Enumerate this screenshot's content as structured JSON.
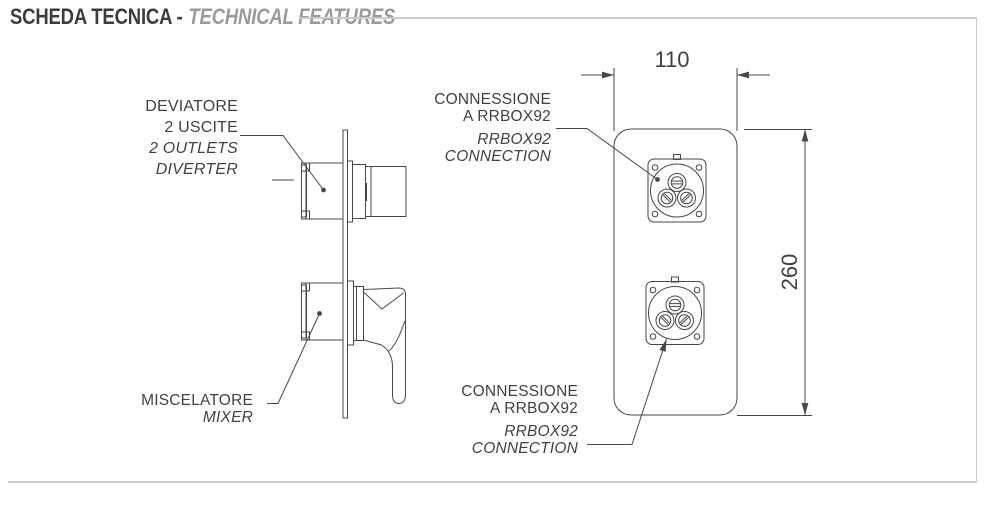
{
  "header": {
    "title_primary": "SCHEDA TECNICA -",
    "title_secondary": "TECHNICAL FEATURES"
  },
  "labels": {
    "diverter": {
      "line1": "DEVIATORE",
      "line2": "2 USCITE",
      "line3": "2 OUTLETS",
      "line4": "DIVERTER"
    },
    "mixer": {
      "line1": "MISCELATORE",
      "line2": "MIXER"
    },
    "connection_top": {
      "line1": "CONNESSIONE",
      "line2": "A RRBOX92",
      "line3": "RRBOX92",
      "line4": "CONNECTION"
    },
    "connection_bottom": {
      "line1": "CONNESSIONE",
      "line2": "A RRBOX92",
      "line3": "RRBOX92",
      "line4": "CONNECTION"
    }
  },
  "dimensions": {
    "plate_width_mm": "110",
    "plate_height_mm": "260"
  },
  "colors": {
    "background": "#ffffff",
    "ink": "#474747",
    "title_primary": "#3c3c3c",
    "title_secondary": "#9a9a9a",
    "frame": "#cbcbcb",
    "label_text": "#414141"
  }
}
